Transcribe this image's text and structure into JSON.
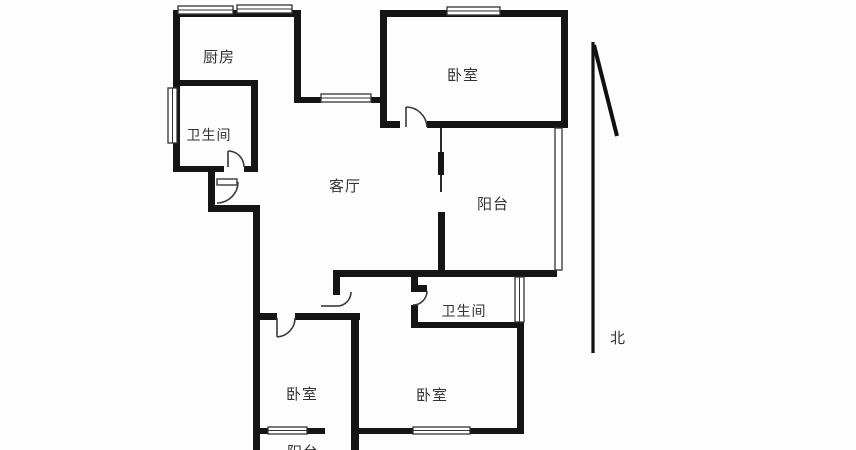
{
  "plan": {
    "type": "apartment-floor-plan",
    "wall_color": "#151515",
    "line_color": "#333333",
    "background": "#fdfdfd"
  },
  "rooms": [
    {
      "id": "kitchen",
      "label": "厨房"
    },
    {
      "id": "bathroom-north",
      "label": "卫生间"
    },
    {
      "id": "bedroom-northeast",
      "label": "卧室"
    },
    {
      "id": "living-room",
      "label": "客厅"
    },
    {
      "id": "balcony-east",
      "label": "阳台"
    },
    {
      "id": "bathroom-south",
      "label": "卫生间"
    },
    {
      "id": "bedroom-southwest",
      "label": "卧室"
    },
    {
      "id": "bedroom-south",
      "label": "卧室"
    },
    {
      "id": "balcony-south",
      "label": "阳台"
    }
  ],
  "compass": {
    "label": "北"
  }
}
